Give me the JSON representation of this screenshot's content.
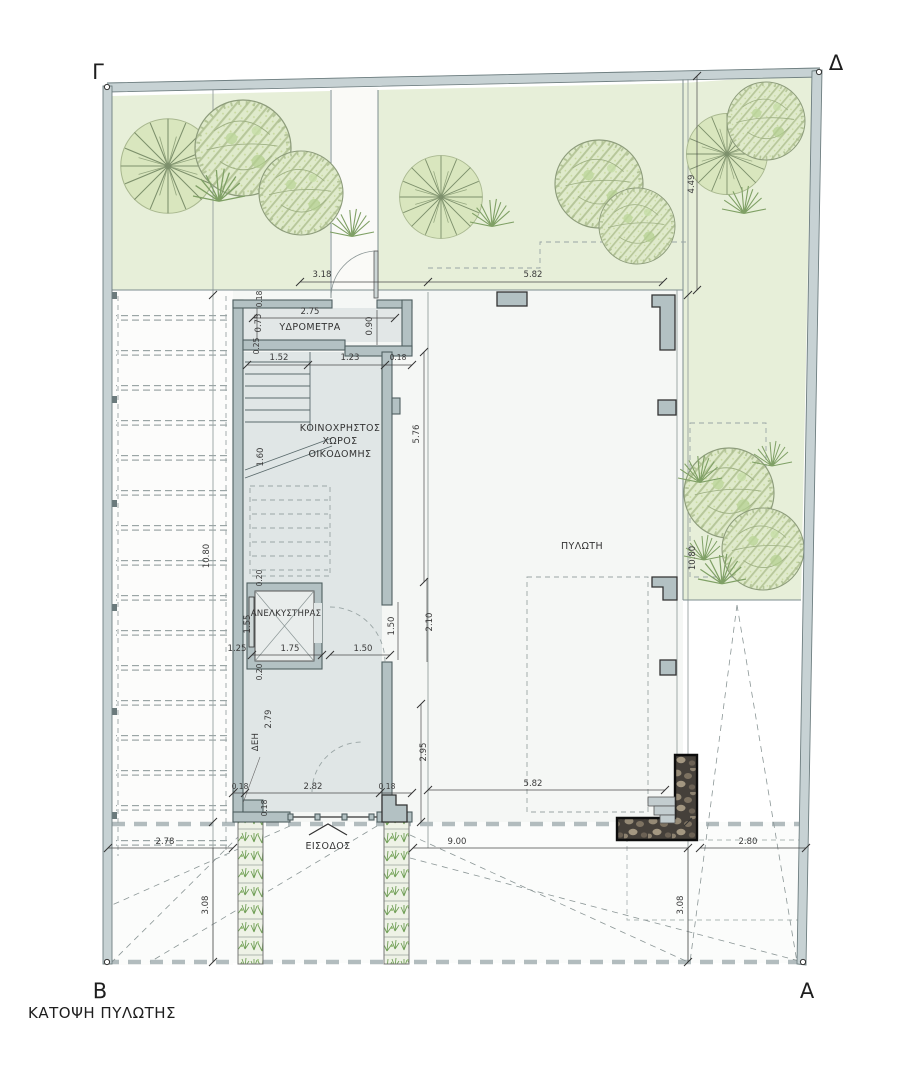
{
  "title": "ΚΑΤΟΨΗ ΠΥΛΩΤΗΣ",
  "corner_labels": {
    "top_left": "Γ",
    "top_right": "Δ",
    "bottom_left": "Β",
    "bottom_right": "Α"
  },
  "labels": {
    "water_meters": "ΥΔΡΟΜΕΤΡΑ",
    "common_area_line1": "ΚΟΙΝΟΧΡΗΣΤΟΣ",
    "common_area_line2": "ΧΩΡΟΣ",
    "common_area_line3": "ΟΙΚΟΔΟΜΗΣ",
    "elevator": "ΑΝΕΛΚΥΣΤΗΡΑΣ",
    "pilotis": "ΠΥΛΩΤΗ",
    "electrical": "ΔΕΗ",
    "entrance": "ΕΙΣΟΔΟΣ"
  },
  "dimensions": {
    "walkway_front": "3.18",
    "pilotis_top": "5.82",
    "right_garden_depth": "4.49",
    "water_room_width": "2.75",
    "water_room_left": "0.75",
    "water_room_right": "0.90",
    "wall_top": "0.18",
    "wall_left": "0.25",
    "stair_flight": "1.52",
    "stair_landing": "1.23",
    "wall_stair": "0.18",
    "common_area_depth": "5.76",
    "stair_run": "1.60",
    "shaft_wall_top": "0.20",
    "shaft_wall_bottom": "0.20",
    "elevator_width": "1.75",
    "elevator_depth": "1.55",
    "elevator_offset": "1.25",
    "door_opening": "1.50",
    "door_swing": "1.50",
    "lobby_bay": "2.10",
    "deh_niche": "2.79",
    "lobby_depth": "2.95",
    "wall_lobby_left": "0.18",
    "lobby_width": "2.82",
    "wall_lobby_right": "0.18",
    "entrance_wall": "0.18",
    "pilotis_bottom": "5.82",
    "left_parking_width": "2.78",
    "driveway_width": "9.00",
    "left_setback": "3.08",
    "right_setback": "3.08",
    "right_parking_width": "2.80",
    "left_garden_length": "10.80",
    "right_garden_length": "10.80"
  },
  "colors": {
    "garden_green": "#e7efd9",
    "wall_gray": "#b3c1c3",
    "boundary_band": "#c7d2d4",
    "interior_gray": "#e2e7e7"
  }
}
